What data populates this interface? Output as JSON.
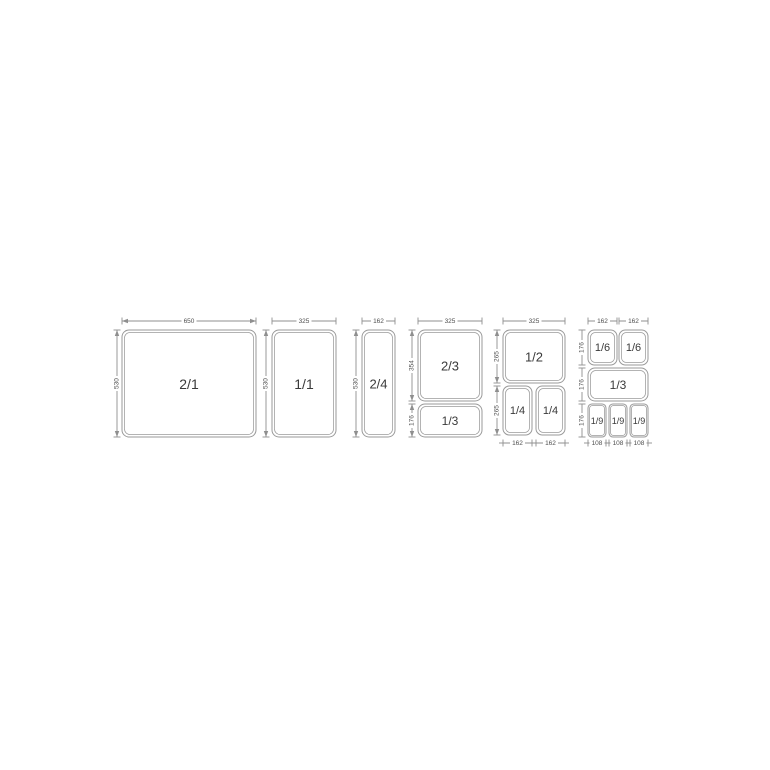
{
  "page": {
    "background": "#ffffff",
    "description": "Gastronorm container size diagram"
  },
  "diagram": {
    "canvas": {
      "width": 770,
      "height": 770
    },
    "colors": {
      "line": "#8f8f8f",
      "pan_border": "#9a9a9a",
      "pan_fill": "#ffffff",
      "pan_label_text": "#3a3a3a",
      "dim_text": "#4f4f4f",
      "background": "#ffffff"
    },
    "pans": [
      {
        "label": "2/1",
        "x": 122,
        "y": 330,
        "w": 134,
        "h": 107,
        "font": 14
      },
      {
        "label": "1/1",
        "x": 272,
        "y": 330,
        "w": 64,
        "h": 107,
        "font": 14
      },
      {
        "label": "2/4",
        "x": 362,
        "y": 330,
        "w": 33,
        "h": 107,
        "font": 13
      },
      {
        "label": "2/3",
        "x": 418,
        "y": 330,
        "w": 64,
        "h": 71,
        "font": 13
      },
      {
        "label": "1/3",
        "x": 418,
        "y": 404,
        "w": 64,
        "h": 33,
        "font": 12
      },
      {
        "label": "1/2",
        "x": 503,
        "y": 330,
        "w": 62,
        "h": 53,
        "font": 13
      },
      {
        "label": "1/4",
        "x": 503,
        "y": 386,
        "w": 29,
        "h": 49,
        "font": 11
      },
      {
        "label": "1/4",
        "x": 536,
        "y": 386,
        "w": 29,
        "h": 49,
        "font": 11
      },
      {
        "label": "1/6",
        "x": 588,
        "y": 330,
        "w": 29,
        "h": 35,
        "font": 11
      },
      {
        "label": "1/6",
        "x": 619,
        "y": 330,
        "w": 29,
        "h": 35,
        "font": 11
      },
      {
        "label": "1/3",
        "x": 588,
        "y": 368,
        "w": 60,
        "h": 33,
        "font": 12
      },
      {
        "label": "1/9",
        "x": 588,
        "y": 404,
        "w": 18,
        "h": 33,
        "font": 9
      },
      {
        "label": "1/9",
        "x": 609,
        "y": 404,
        "w": 18,
        "h": 33,
        "font": 9
      },
      {
        "label": "1/9",
        "x": 630,
        "y": 404,
        "w": 18,
        "h": 33,
        "font": 9
      }
    ],
    "dims": [
      {
        "label": "650",
        "orient": "h",
        "x1": 122,
        "x2": 256,
        "y": 321,
        "style": "arrow"
      },
      {
        "label": "325",
        "orient": "h",
        "x1": 272,
        "x2": 336,
        "y": 321,
        "style": "tick"
      },
      {
        "label": "162",
        "orient": "h",
        "x1": 362,
        "x2": 395,
        "y": 321,
        "style": "tick"
      },
      {
        "label": "325",
        "orient": "h",
        "x1": 418,
        "x2": 482,
        "y": 321,
        "style": "tick"
      },
      {
        "label": "325",
        "orient": "h",
        "x1": 503,
        "x2": 565,
        "y": 321,
        "style": "tick"
      },
      {
        "label": "162",
        "orient": "h",
        "x1": 588,
        "x2": 617,
        "y": 321,
        "style": "tick"
      },
      {
        "label": "162",
        "orient": "h",
        "x1": 619,
        "x2": 648,
        "y": 321,
        "style": "tick"
      },
      {
        "label": "530",
        "orient": "v",
        "y1": 330,
        "y2": 437,
        "x": 117,
        "style": "arrow"
      },
      {
        "label": "530",
        "orient": "v",
        "y1": 330,
        "y2": 437,
        "x": 266,
        "style": "arrow"
      },
      {
        "label": "530",
        "orient": "v",
        "y1": 330,
        "y2": 437,
        "x": 356,
        "style": "arrow"
      },
      {
        "label": "354",
        "orient": "v",
        "y1": 330,
        "y2": 401,
        "x": 412,
        "style": "arrow"
      },
      {
        "label": "176",
        "orient": "v",
        "y1": 404,
        "y2": 437,
        "x": 412,
        "style": "arrow"
      },
      {
        "label": "265",
        "orient": "v",
        "y1": 330,
        "y2": 383,
        "x": 497,
        "style": "arrow"
      },
      {
        "label": "265",
        "orient": "v",
        "y1": 386,
        "y2": 435,
        "x": 497,
        "style": "arrow"
      },
      {
        "label": "176",
        "orient": "v",
        "y1": 330,
        "y2": 365,
        "x": 582,
        "style": "tick"
      },
      {
        "label": "176",
        "orient": "v",
        "y1": 368,
        "y2": 401,
        "x": 582,
        "style": "tick"
      },
      {
        "label": "176",
        "orient": "v",
        "y1": 404,
        "y2": 437,
        "x": 582,
        "style": "tick"
      },
      {
        "label": "162",
        "orient": "h",
        "x1": 503,
        "x2": 532,
        "y": 443,
        "style": "stub"
      },
      {
        "label": "162",
        "orient": "h",
        "x1": 536,
        "x2": 565,
        "y": 443,
        "style": "stub"
      },
      {
        "label": "108",
        "orient": "h",
        "x1": 588,
        "x2": 606,
        "y": 443,
        "style": "stub"
      },
      {
        "label": "108",
        "orient": "h",
        "x1": 609,
        "x2": 627,
        "y": 443,
        "style": "stub"
      },
      {
        "label": "108",
        "orient": "h",
        "x1": 630,
        "x2": 648,
        "y": 443,
        "style": "stub"
      }
    ]
  }
}
